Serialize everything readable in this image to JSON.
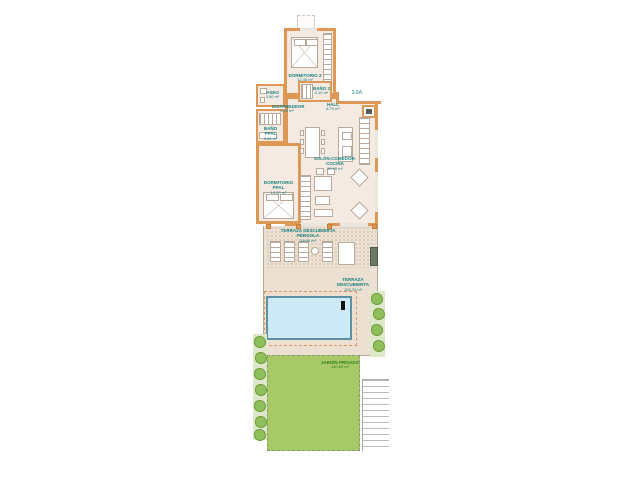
{
  "unit_label": "3.0A",
  "colors": {
    "wall": "#dd9855",
    "wall_dark": "#c67d36",
    "room_fill": "#f5eae1",
    "terrace_fill": "#ece0d2",
    "pool_fill": "#cde9f6",
    "pool_border": "#5e8fa3",
    "garden_fill": "#a7c966",
    "bush_fill": "#8fbf5a",
    "label_teal": "#15807f",
    "label_green": "#2f7d1f"
  },
  "rooms": {
    "dormitorio2": {
      "name": "DORMITORIO 2",
      "area": "12.45 m²"
    },
    "bano2": {
      "name": "BAÑO 2",
      "area": "4.10 m²"
    },
    "aseo": {
      "name": "ASEO",
      "area": "3.50 m²"
    },
    "distribuidor": {
      "name": "DISTRIBUIDOR",
      "area": "3.05 m²"
    },
    "bano_ppal": {
      "name": "BAÑO PPAL",
      "area": "5.84 m²"
    },
    "dormitorio_ppal": {
      "name": "DORMITORIO PPAL",
      "area": "14.20 m²"
    },
    "hall": {
      "name": "HALL",
      "area": "8.70 m²"
    },
    "salon": {
      "name": "SALÓN-COMEDOR-COCINA",
      "area": "30.95 m²"
    },
    "terraza_pergola": {
      "name": "TERRAZA DESCUBIERTA PÉRGOLA",
      "area": "19.90 m²"
    },
    "terraza": {
      "name": "TERRAZA DESCUBIERTA",
      "area": "103.20 m²"
    },
    "jardin": {
      "name": "JARDÍN PRIVADO",
      "area": "140.60 m²"
    }
  }
}
